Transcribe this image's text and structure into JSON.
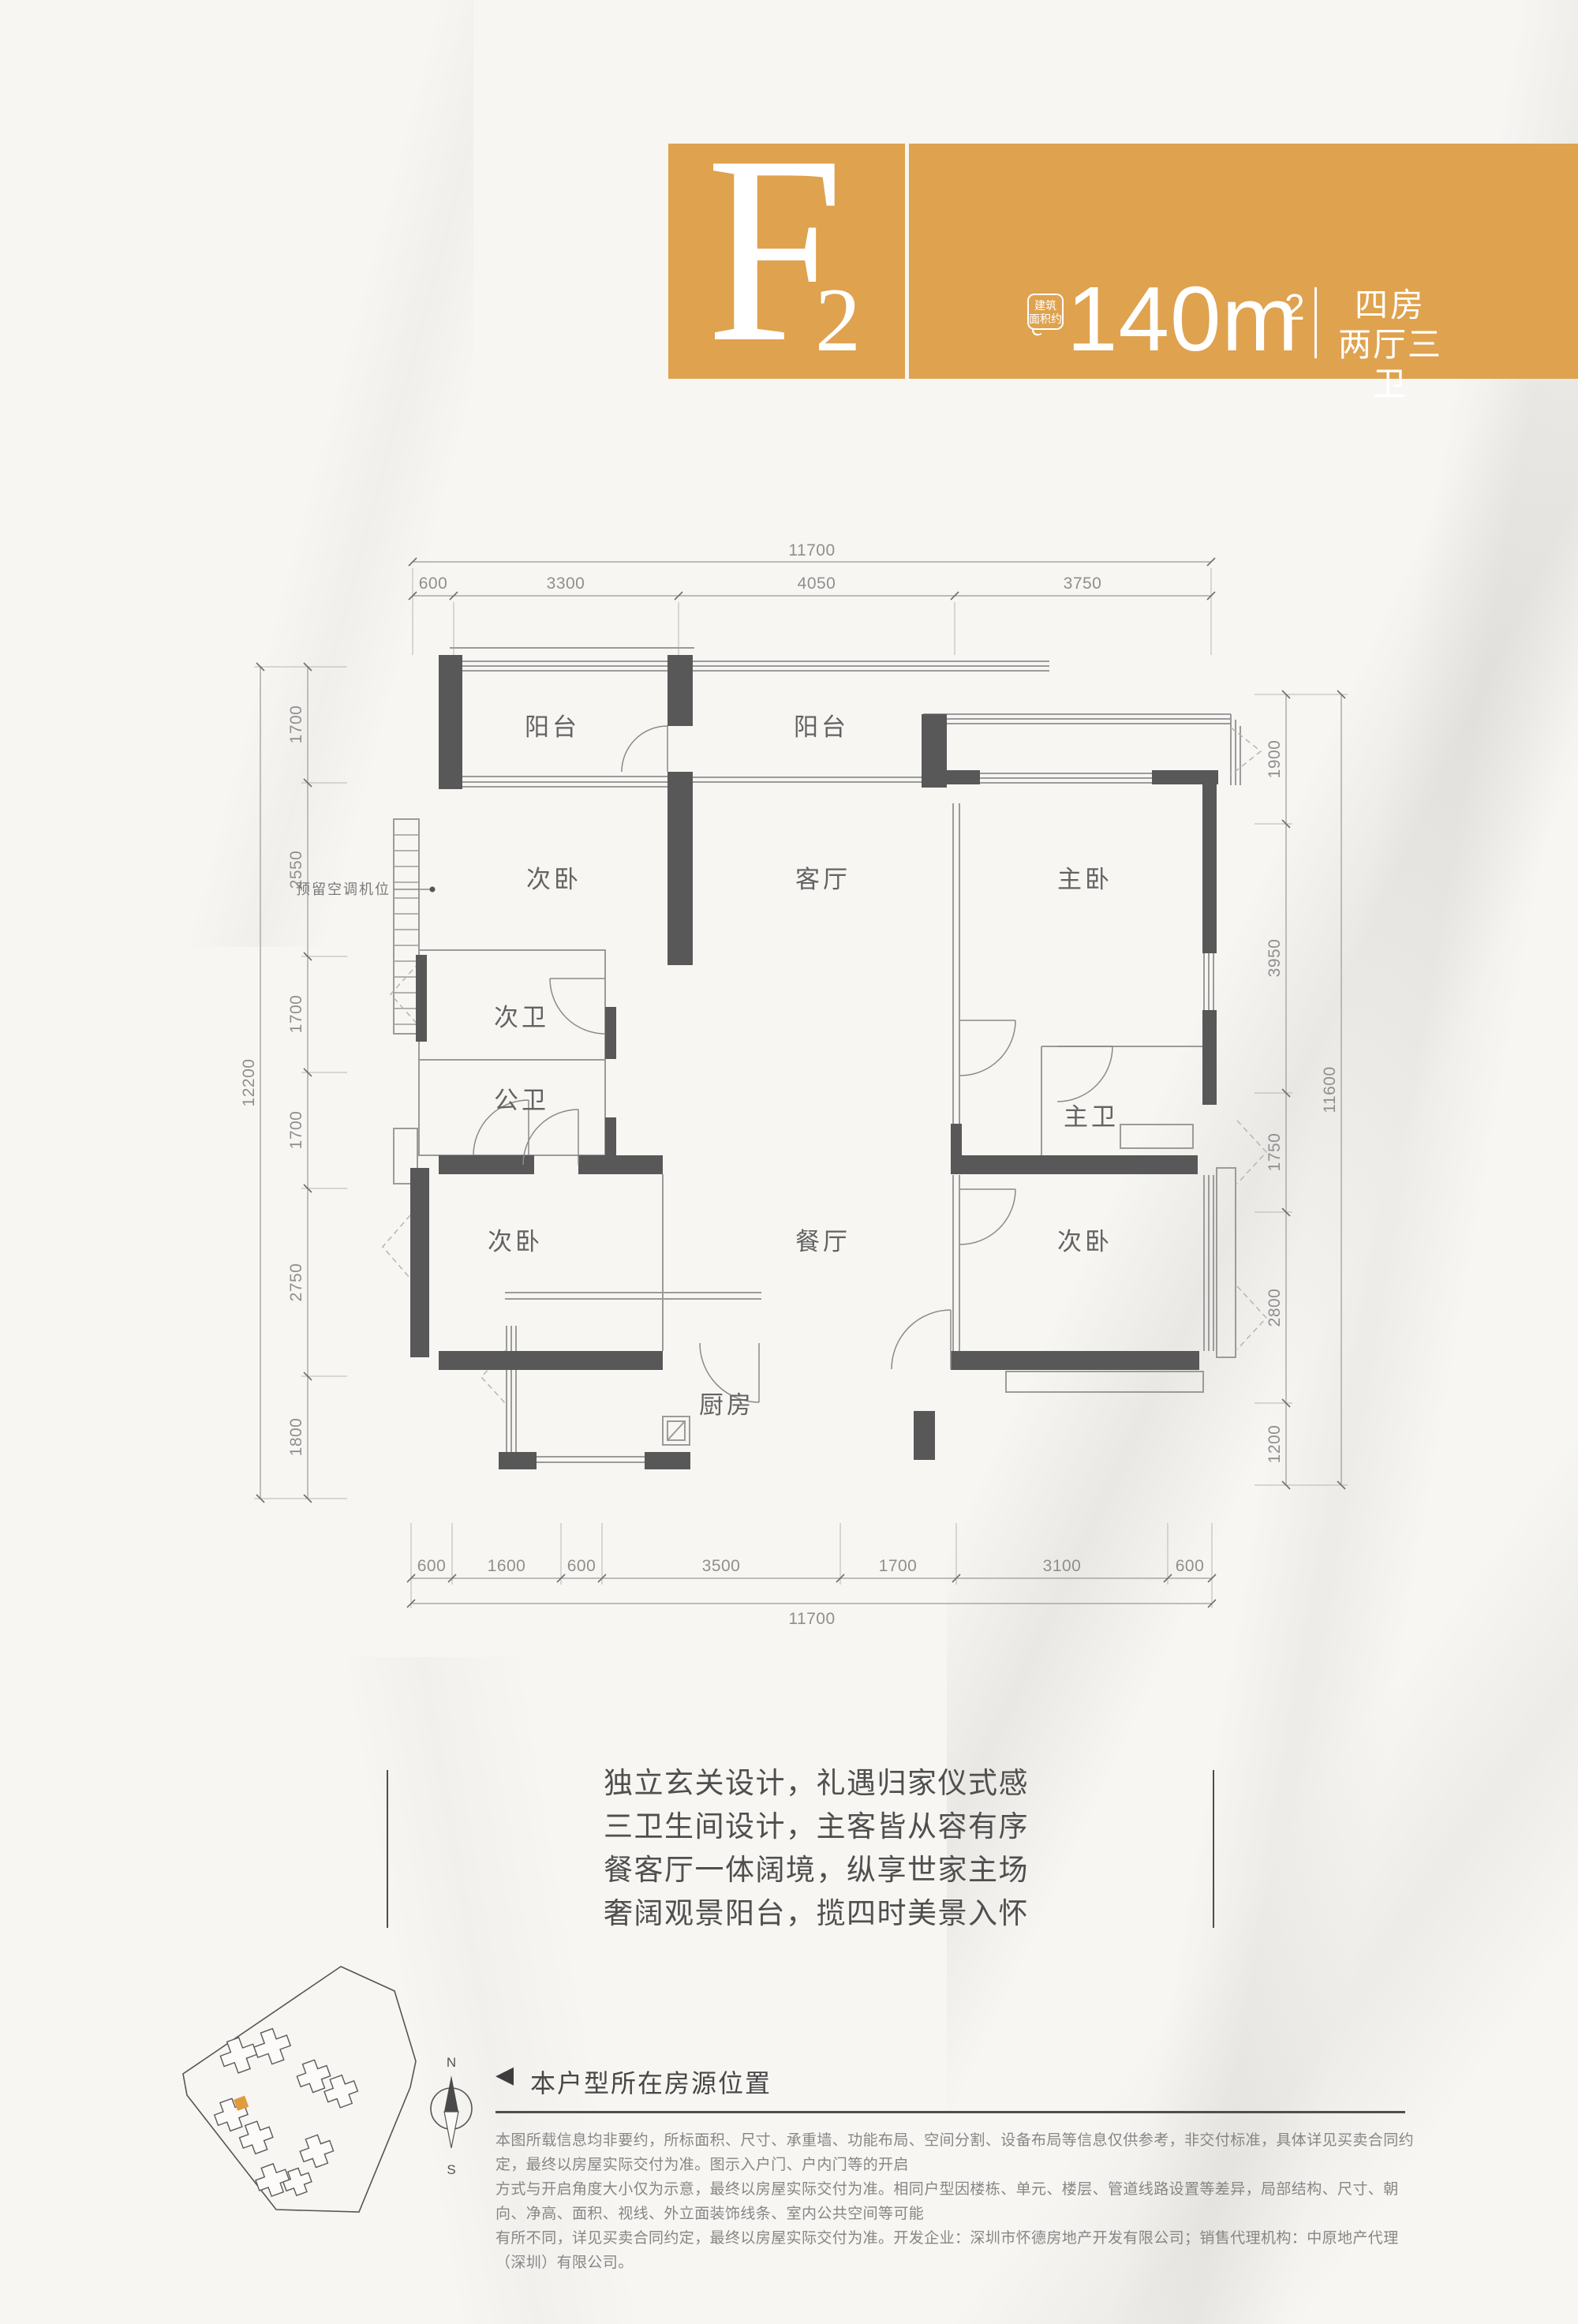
{
  "banner": {
    "unit_letter": "F",
    "unit_number": "2",
    "area_badge_line1": "建筑",
    "area_badge_line2": "面积约",
    "area_value": "140m",
    "area_sup": "2",
    "rooms_line1": "四房",
    "rooms_line2": "两厅三卫"
  },
  "fp": {
    "rooms": {
      "balcony_left": "阳台",
      "balcony_center": "阳台",
      "bed_top_left": "次卧",
      "living": "客厅",
      "master": "主卧",
      "bath_second": "次卫",
      "bath_public": "公卫",
      "bath_master": "主卫",
      "bed_bottom_left": "次卧",
      "dining": "餐厅",
      "bed_bottom_right": "次卧",
      "kitchen": "厨房"
    },
    "ac_note": "预留空调机位",
    "dims_top_total": "11700",
    "dims_top": [
      "600",
      "3300",
      "4050",
      "3750"
    ],
    "dims_bottom": [
      "600",
      "1600",
      "600",
      "3500",
      "1700",
      "3100",
      "600"
    ],
    "dims_bottom_total": "11700",
    "dims_left": [
      "1700",
      "2550",
      "1700",
      "1700",
      "2750",
      "1800"
    ],
    "dims_left_total": "12200",
    "dims_right": [
      "1900",
      "3950",
      "1750",
      "2800",
      "1200"
    ],
    "dims_right_total": "11600"
  },
  "marketing": {
    "line1": "独立玄关设计，礼遇归家仪式感",
    "line2": "三卫生间设计，主客皆从容有序",
    "line3": "餐客厅一体阔境，纵享世家主场",
    "line4": "奢阔观景阳台，揽四时美景入怀"
  },
  "location": {
    "marker": "◀",
    "label": "本户型所在房源位置",
    "compass_north": "N",
    "compass_south": "S"
  },
  "disclaimer": {
    "line1": "本图所载信息均非要约，所标面积、尺寸、承重墙、功能布局、空间分割、设备布局等信息仅供参考，非交付标准，具体详见买卖合同约定，最终以房屋实际交付为准。图示入户门、户内门等的开启",
    "line2": "方式与开启角度大小仅为示意，最终以房屋实际交付为准。相同户型因楼栋、单元、楼层、管道线路设置等差异，局部结构、尺寸、朝向、净高、面积、视线、外立面装饰线条、室内公共空间等可能",
    "line3": "有所不同，详见买卖合同约定，最终以房屋实际交付为准。开发企业：深圳市怀德房地产开发有限公司；销售代理机构：中原地产代理（深圳）有限公司。"
  },
  "colors": {
    "banner_gold": "#DFA24E",
    "wall_dark": "#585858",
    "highlight_unit_orange": "#E09B3E",
    "paper": "#f7f6f3"
  }
}
